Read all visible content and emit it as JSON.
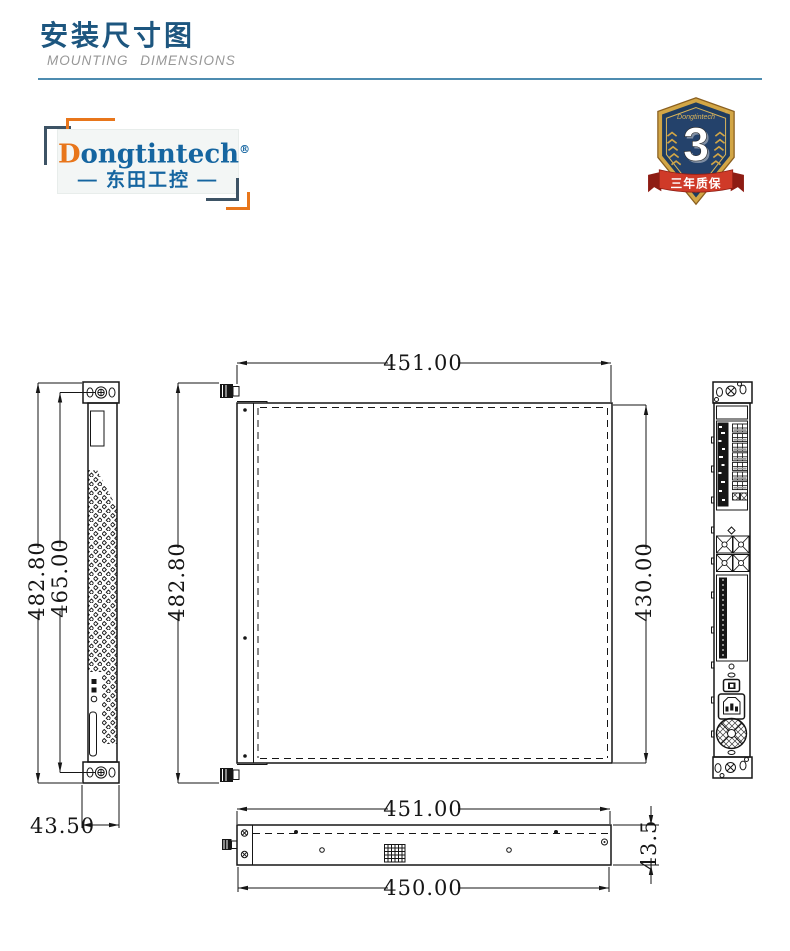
{
  "header": {
    "title_cn": "安装尺寸图",
    "title_en": "MOUNTING DIMENSIONS"
  },
  "logo": {
    "brand_initial": "D",
    "brand_rest": "ongtintech",
    "reg": "®",
    "dash_left": "—",
    "brand_cn": "东田工控",
    "dash_right": "—"
  },
  "badge": {
    "brand": "Dongtintech",
    "reg": "®",
    "number": "3",
    "ribbon": "三年质保"
  },
  "drawing": {
    "front_view": {
      "dim_overall_height": "482.80",
      "dim_inner_height": "465.00",
      "dim_width": "43.50"
    },
    "top_view": {
      "dim_width": "451.00",
      "dim_overall_depth": "482.80",
      "dim_body_depth": "430.00"
    },
    "side_view": {
      "dim_top_width": "451.00",
      "dim_bottom_width": "450.00",
      "dim_height": "43.5"
    }
  },
  "colors": {
    "title_blue": "#1d567f",
    "divider_blue": "#4d8cb0",
    "logo_blue": "#1565a0",
    "logo_orange": "#e8761b",
    "badge_navy": "#1e3c60",
    "badge_gold": "#d2a646",
    "ribbon_red": "#cf3a28",
    "line_black": "#161616"
  }
}
